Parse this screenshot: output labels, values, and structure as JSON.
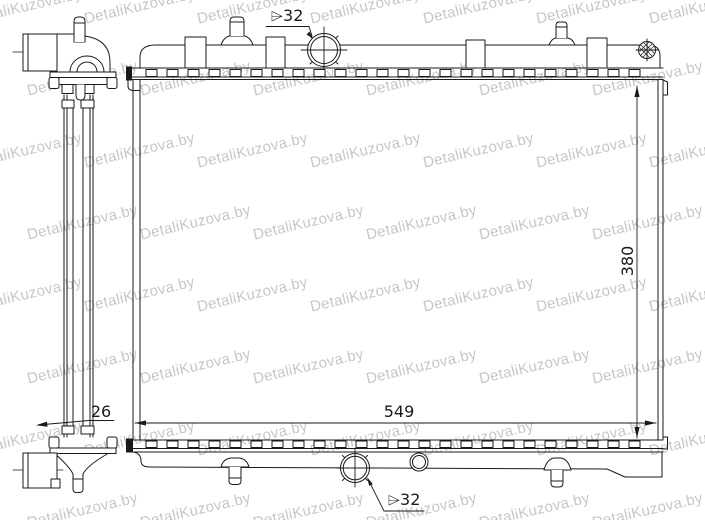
{
  "watermark": {
    "text": "DetaliKuzova.by"
  },
  "drawing": {
    "subject": "radiator-technical-drawing",
    "views": {
      "left": "side-profile-view",
      "right": "front-view"
    },
    "dimensions": {
      "core_width": "549",
      "core_height": "380",
      "core_depth": "26",
      "top_port_diameter": "⌲32",
      "bottom_port_diameter": "⌲32"
    },
    "colors": {
      "line": "#1a1a1a",
      "background": "#ffffff",
      "watermark": "#989898"
    }
  }
}
